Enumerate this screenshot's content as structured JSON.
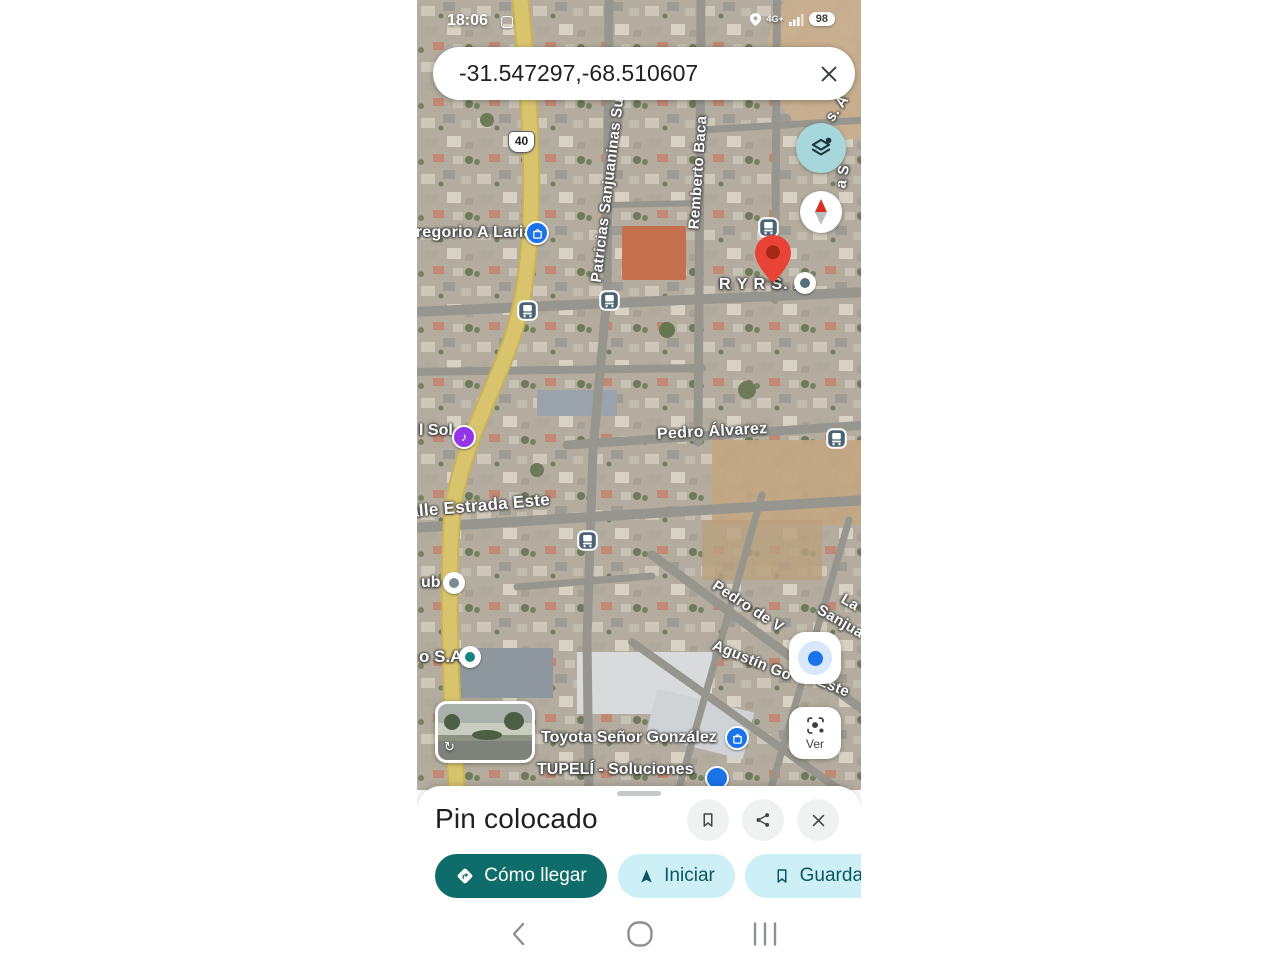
{
  "status_bar": {
    "time": "18:06",
    "network": "4G+",
    "battery_percent": "98"
  },
  "search_bar": {
    "query": "-31.547297,-68.510607"
  },
  "map": {
    "route_shield": "40",
    "labels": {
      "gregorio": "Gregorio A Laria",
      "patricias": "Patricias Sanjuaninas Su",
      "remberto": "Remberto Baca",
      "edge_top": "s. A",
      "edge_mid": "a S",
      "ryrsa": "R Y R S. A",
      "sol": "l Sol",
      "pedro_alvarez": "Pedro Álvarez",
      "estrada": "alle Estrada Este",
      "club": "ub",
      "osa": "o S.A",
      "pedro_de": "Pedro de V",
      "la": "La",
      "sanjua": "Sanjua",
      "agustin": "Agustín Go",
      "este": "Este",
      "toyota": "Toyota Señor González",
      "tupeli": "TUPELÍ - Soluciones"
    },
    "buttons": {
      "ver": "Ver"
    }
  },
  "bottom_sheet": {
    "title": "Pin colocado",
    "actions": {
      "directions": "Cómo llegar",
      "start": "Iniciar",
      "save": "Guardar"
    }
  },
  "colors": {
    "accent_teal": "#0e6d6a",
    "chip_bg": "#cdf0f6",
    "chip_text": "#0b5760",
    "pin_red": "#ea4335",
    "poi_blue": "#1a73e8",
    "layers_bg": "#a5d7db"
  }
}
